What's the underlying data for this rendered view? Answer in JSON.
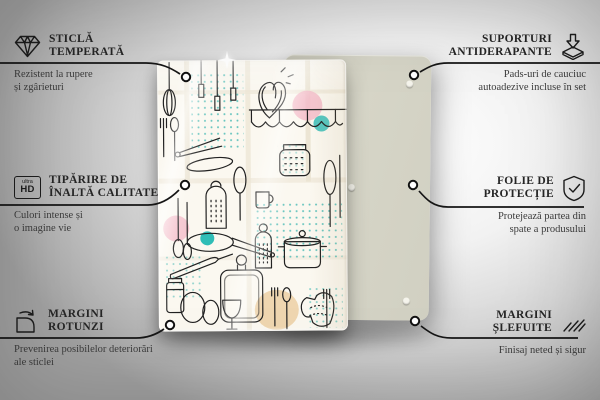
{
  "colors": {
    "background_center": "#ffffff",
    "background_edge": "#a2a2a2",
    "back_panel": "#d3d2c4",
    "glass_base": "#fbf8f0",
    "line_art": "#212121",
    "accent_teal": "#3fb6b2",
    "accent_pink": "#f3bcc9",
    "accent_tan": "#ecd0a4",
    "callout_line": "#161616",
    "text": "#2b2b2b"
  },
  "features": [
    {
      "id": "tempered-glass",
      "icon": "diamond-icon",
      "title": [
        "STICLĂ",
        "TEMPERATĂ"
      ],
      "desc": [
        "Rezistent la rupere",
        "și zgârieturi"
      ]
    },
    {
      "id": "hd-printing",
      "icon": "ultra-hd-icon",
      "icon_text": {
        "top": "ultra",
        "bottom": "HD"
      },
      "title": [
        "TIPĂRIRE DE",
        "ÎNALTĂ CALITATE"
      ],
      "desc": [
        "Culori intense și",
        "o imagine vie"
      ]
    },
    {
      "id": "rounded-corners",
      "icon": "rounded-corner-icon",
      "title": [
        "MARGINI",
        "ROTUNZI"
      ],
      "desc": [
        "Prevenirea posibilelor deteriorări",
        "ale sticlei"
      ]
    },
    {
      "id": "anti-slip-pads",
      "icon": "pad-press-icon",
      "title": [
        "SUPORTURI",
        "ANTIDERAPANTE"
      ],
      "desc": [
        "Pads-uri de cauciuc",
        "autoadezive incluse în set"
      ]
    },
    {
      "id": "protective-film",
      "icon": "shield-check-icon",
      "title": [
        "FOLIE DE",
        "PROTECȚIE"
      ],
      "desc": [
        "Protejează partea din",
        "spate a produsului"
      ]
    },
    {
      "id": "polished-edges",
      "icon": "polished-edge-icon",
      "title": [
        "MARGINI",
        "ȘLEFUITE"
      ],
      "desc": [
        "Finisaj neted și sigur"
      ]
    }
  ]
}
